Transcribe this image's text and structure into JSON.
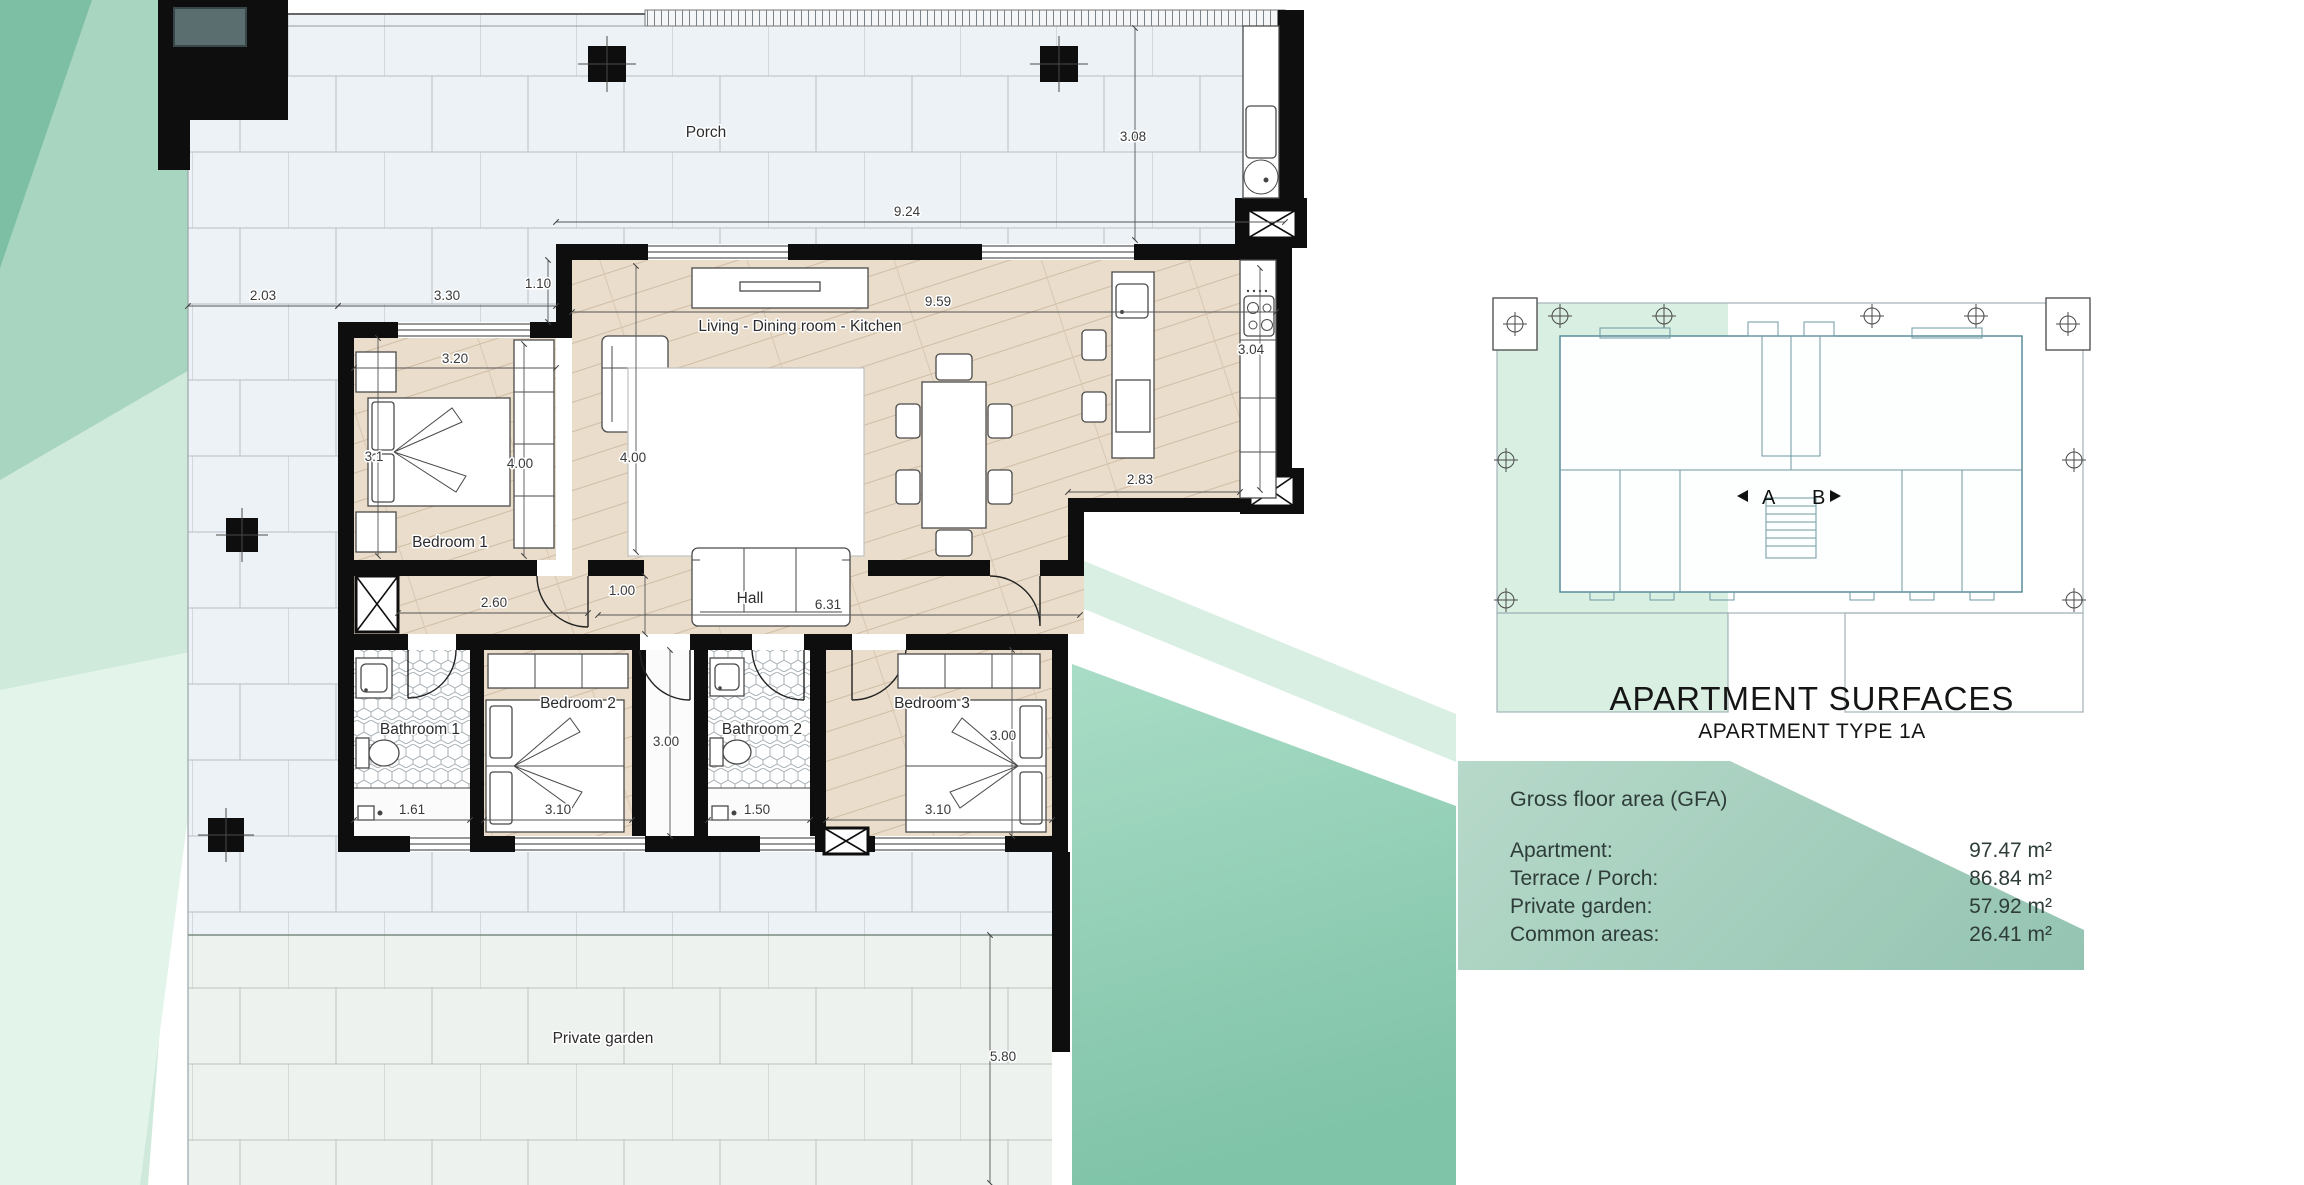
{
  "surfaces": {
    "title": "APARTMENT SURFACES",
    "subtitle": "APARTMENT TYPE 1A",
    "header": "Gross floor area (GFA)",
    "rows": [
      {
        "label": "Apartment:",
        "value": "97.47 m²"
      },
      {
        "label": "Terrace / Porch:",
        "value": "86.84 m²"
      },
      {
        "label": "Private garden:",
        "value": "57.92 m²"
      },
      {
        "label": "Common areas:",
        "value": "26.41 m²"
      }
    ]
  },
  "site_plan": {
    "unit_a_label": "A",
    "unit_b_label": "B"
  },
  "floor_plan": {
    "room_labels": [
      {
        "id": "porch",
        "label": "Porch",
        "x": 706,
        "y": 137
      },
      {
        "id": "living-dining-kitchen",
        "label": "Living - Dining room - Kitchen",
        "x": 800,
        "y": 331
      },
      {
        "id": "bedroom-1",
        "label": "Bedroom 1",
        "x": 450,
        "y": 547
      },
      {
        "id": "hall",
        "label": "Hall",
        "x": 750,
        "y": 603
      },
      {
        "id": "bathroom-1",
        "label": "Bathroom 1",
        "x": 420,
        "y": 734
      },
      {
        "id": "bedroom-2",
        "label": "Bedroom 2",
        "x": 578,
        "y": 708
      },
      {
        "id": "bathroom-2",
        "label": "Bathroom 2",
        "x": 762,
        "y": 734
      },
      {
        "id": "bedroom-3",
        "label": "Bedroom 3",
        "x": 932,
        "y": 708
      },
      {
        "id": "private-garden",
        "label": "Private garden",
        "x": 603,
        "y": 1043
      }
    ],
    "dimensions": [
      {
        "label": "2.03",
        "x": 263,
        "y": 300
      },
      {
        "label": "3.30",
        "x": 447,
        "y": 300
      },
      {
        "label": "1.10",
        "x": 538,
        "y": 288
      },
      {
        "label": "9.24",
        "x": 907,
        "y": 216
      },
      {
        "label": "3.08",
        "x": 1133,
        "y": 141
      },
      {
        "label": "9.59",
        "x": 938,
        "y": 306
      },
      {
        "label": "3.04",
        "x": 1251,
        "y": 354
      },
      {
        "label": "2.83",
        "x": 1140,
        "y": 484
      },
      {
        "label": "4.00",
        "x": 633,
        "y": 462
      },
      {
        "label": "3.20",
        "x": 455,
        "y": 363
      },
      {
        "label": "3.1",
        "x": 374,
        "y": 461
      },
      {
        "label": "4.00",
        "x": 520,
        "y": 468
      },
      {
        "label": "2.60",
        "x": 494,
        "y": 607
      },
      {
        "label": "1.00",
        "x": 622,
        "y": 595
      },
      {
        "label": "6.31",
        "x": 828,
        "y": 609
      },
      {
        "label": "3.00",
        "x": 666,
        "y": 746
      },
      {
        "label": "1.61",
        "x": 412,
        "y": 814
      },
      {
        "label": "3.10",
        "x": 558,
        "y": 814
      },
      {
        "label": "1.50",
        "x": 757,
        "y": 814
      },
      {
        "label": "3.10",
        "x": 938,
        "y": 814
      },
      {
        "label": "3.00",
        "x": 1003,
        "y": 740
      },
      {
        "label": "5.80",
        "x": 1003,
        "y": 1061
      }
    ]
  }
}
